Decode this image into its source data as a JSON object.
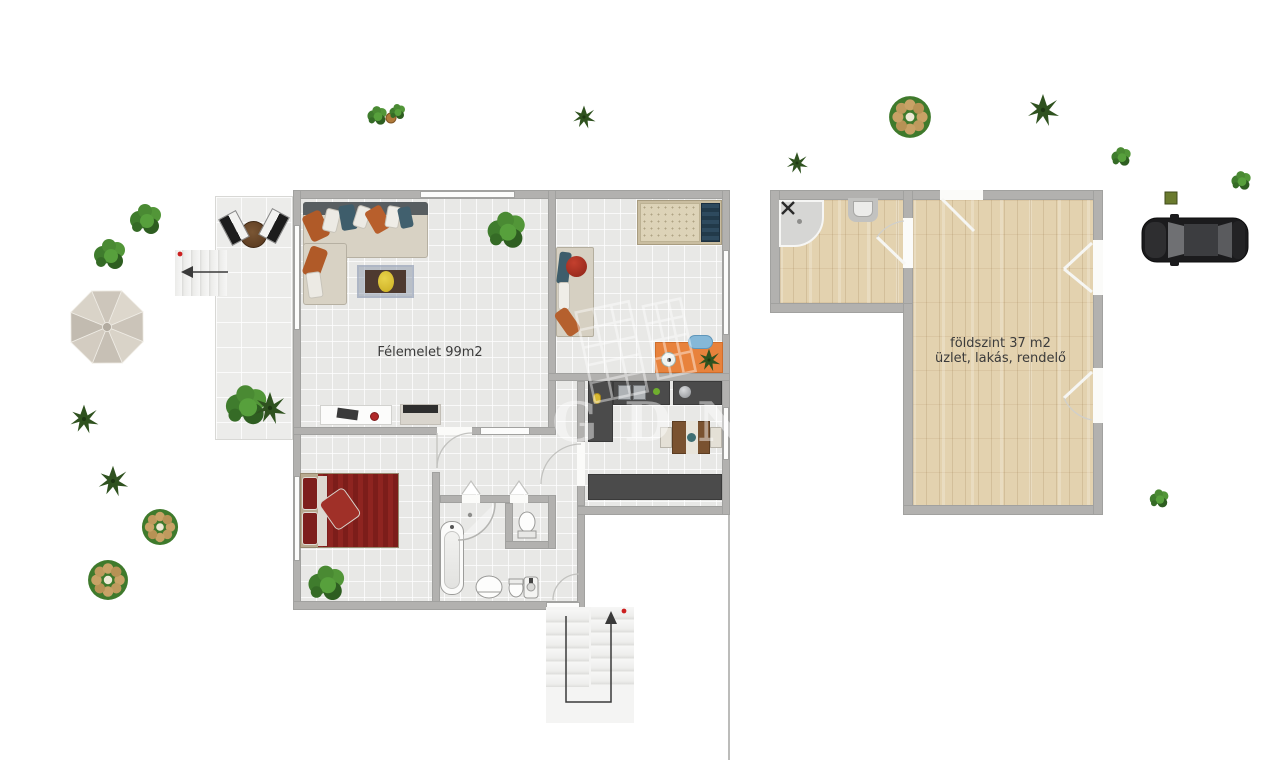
{
  "left_plan": {
    "label": "Félemelet 99m2"
  },
  "right_plan": {
    "label_line1": "földszint 37 m2",
    "label_line2": "üzlet, lakás, rendelő"
  },
  "watermark": {
    "text": "GDN"
  },
  "colors": {
    "wall": "#b2b1af",
    "tile_floor": "#e8e8e6",
    "terrace_floor": "#ececea",
    "wood_floor": "#e3d2af",
    "kitchen_counter": "#4b4b4b",
    "bed_red": "#8e2420",
    "desk_orange": "#e8823c",
    "chair_blue": "#85b8d8",
    "label_text": "#3b3b3b",
    "arrow": "#3a3a3a",
    "marker_red": "#cc2020"
  }
}
